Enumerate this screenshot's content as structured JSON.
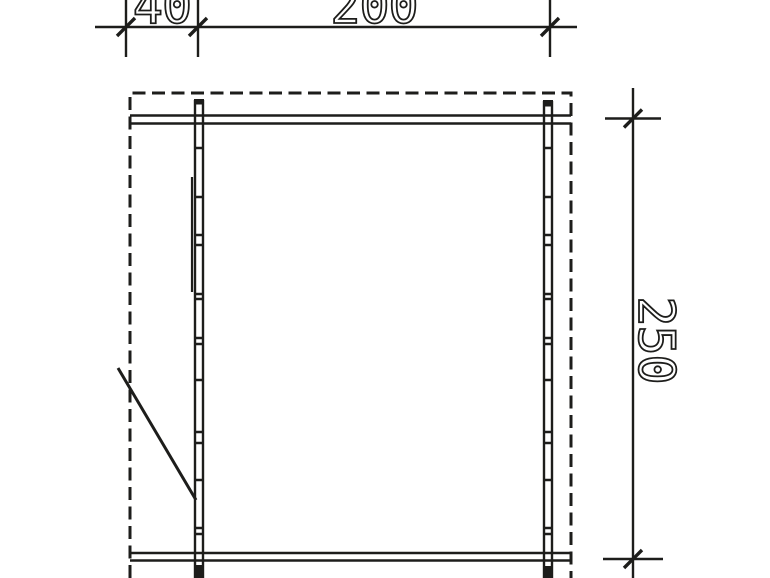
{
  "drawing": {
    "kind": "cad-floor-plan",
    "background_color": "#ffffff",
    "line_color": "#1d1d1b",
    "dimensions": {
      "door_width": "40",
      "front_width": "200",
      "side_depth": "250"
    }
  }
}
